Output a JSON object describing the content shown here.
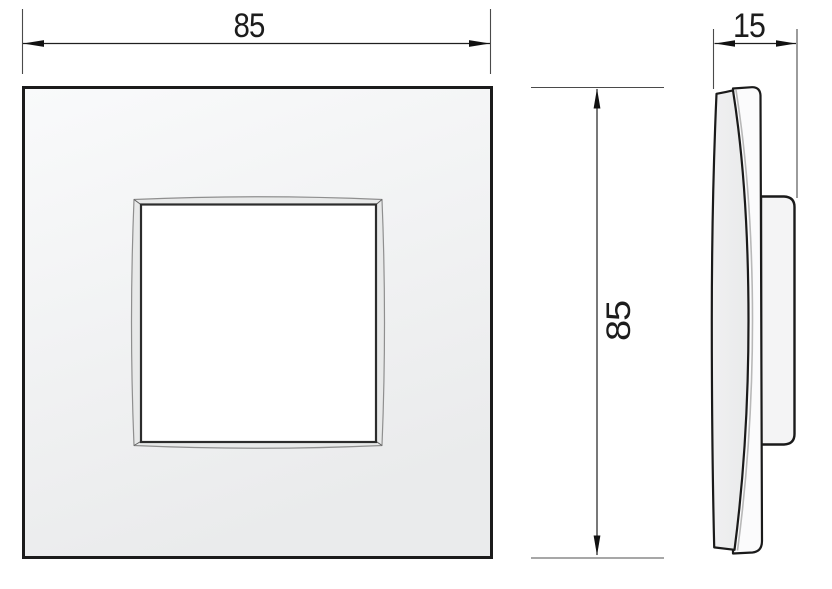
{
  "drawing": {
    "kind": "technical-orthographic-views",
    "dimensions": [
      {
        "id": "front-width",
        "value": "85",
        "orientation": "horizontal"
      },
      {
        "id": "side-depth",
        "value": "15",
        "orientation": "horizontal"
      },
      {
        "id": "front-height",
        "value": "85",
        "orientation": "vertical"
      }
    ],
    "colors": {
      "background": "#ffffff",
      "outline": "#1a1a1a",
      "plate_fill_light": "#f9fafb",
      "plate_fill_dark": "#eaebec",
      "bevel_fill": "#e8e9e9",
      "opening_fill": "#ffffff",
      "dimension_line": "#222222",
      "extension_line": "#4a4a4a"
    }
  }
}
